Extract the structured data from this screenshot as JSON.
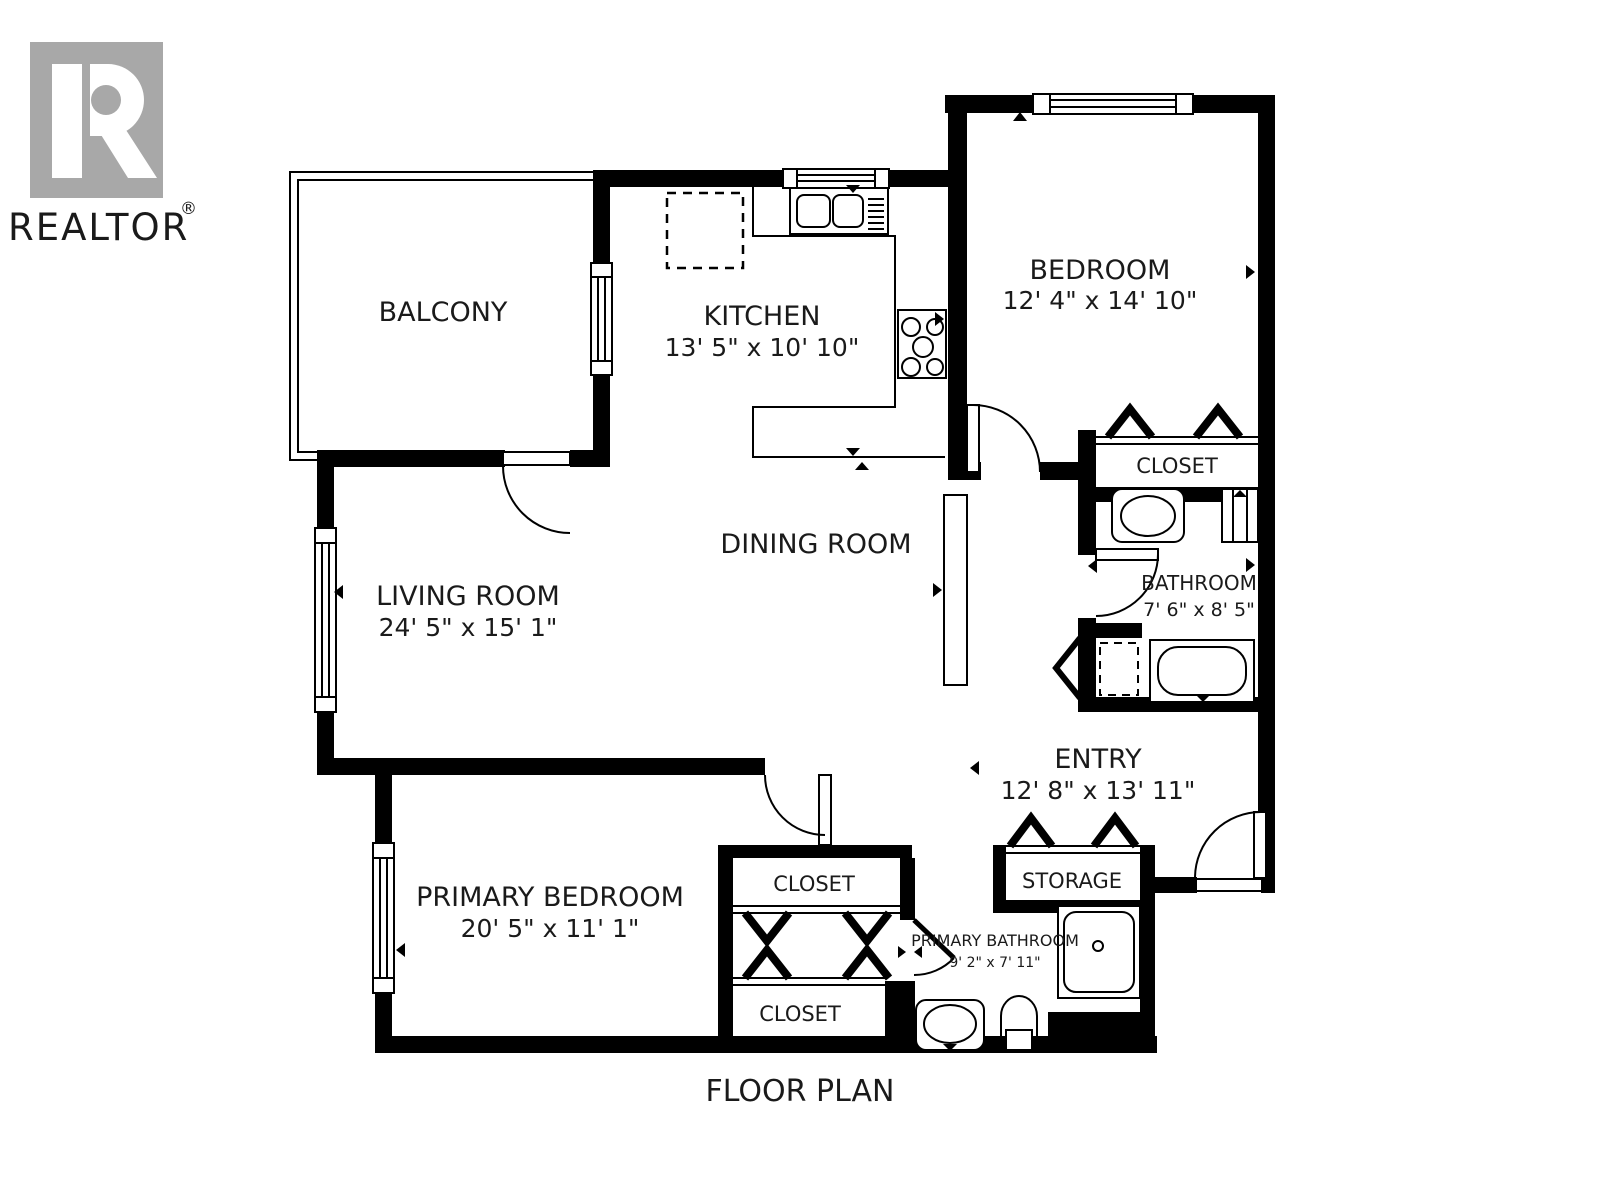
{
  "branding": {
    "logo_text": "REALTOR",
    "registered_mark": "®",
    "logo_color": "#a8a8a8"
  },
  "plan": {
    "title": "FLOOR PLAN",
    "wall_color": "#000000",
    "background_color": "#ffffff"
  },
  "rooms": {
    "balcony": {
      "name": "BALCONY"
    },
    "kitchen": {
      "name": "KITCHEN",
      "dimensions": "13' 5\" x 10' 10\""
    },
    "bedroom": {
      "name": "BEDROOM",
      "dimensions": "12' 4\" x 14' 10\""
    },
    "bedroom_closet": {
      "name": "CLOSET"
    },
    "bathroom": {
      "name": "BATHROOM",
      "dimensions": "7' 6\" x 8' 5\""
    },
    "dining_room": {
      "name": "DINING ROOM"
    },
    "living_room": {
      "name": "LIVING ROOM",
      "dimensions": "24' 5\" x 15' 1\""
    },
    "entry": {
      "name": "ENTRY",
      "dimensions": "12' 8\" x 13' 11\""
    },
    "primary_bedroom": {
      "name": "PRIMARY BEDROOM",
      "dimensions": "20' 5\" x 11' 1\""
    },
    "closet_upper": {
      "name": "CLOSET"
    },
    "closet_lower": {
      "name": "CLOSET"
    },
    "storage": {
      "name": "STORAGE"
    },
    "primary_bathroom": {
      "name": "PRIMARY BATHROOM",
      "dimensions": "9' 2\" x 7' 11\""
    }
  },
  "fixtures": [
    "kitchen-sink-icon",
    "stove-icon",
    "dishwasher-dashed-icon",
    "bathtub-icon",
    "toilet-icon",
    "vanity-sink-icon",
    "washer-dryer-dashed-icon",
    "shower-icon",
    "window-icon",
    "door-swing-icon",
    "bifold-door-icon"
  ]
}
